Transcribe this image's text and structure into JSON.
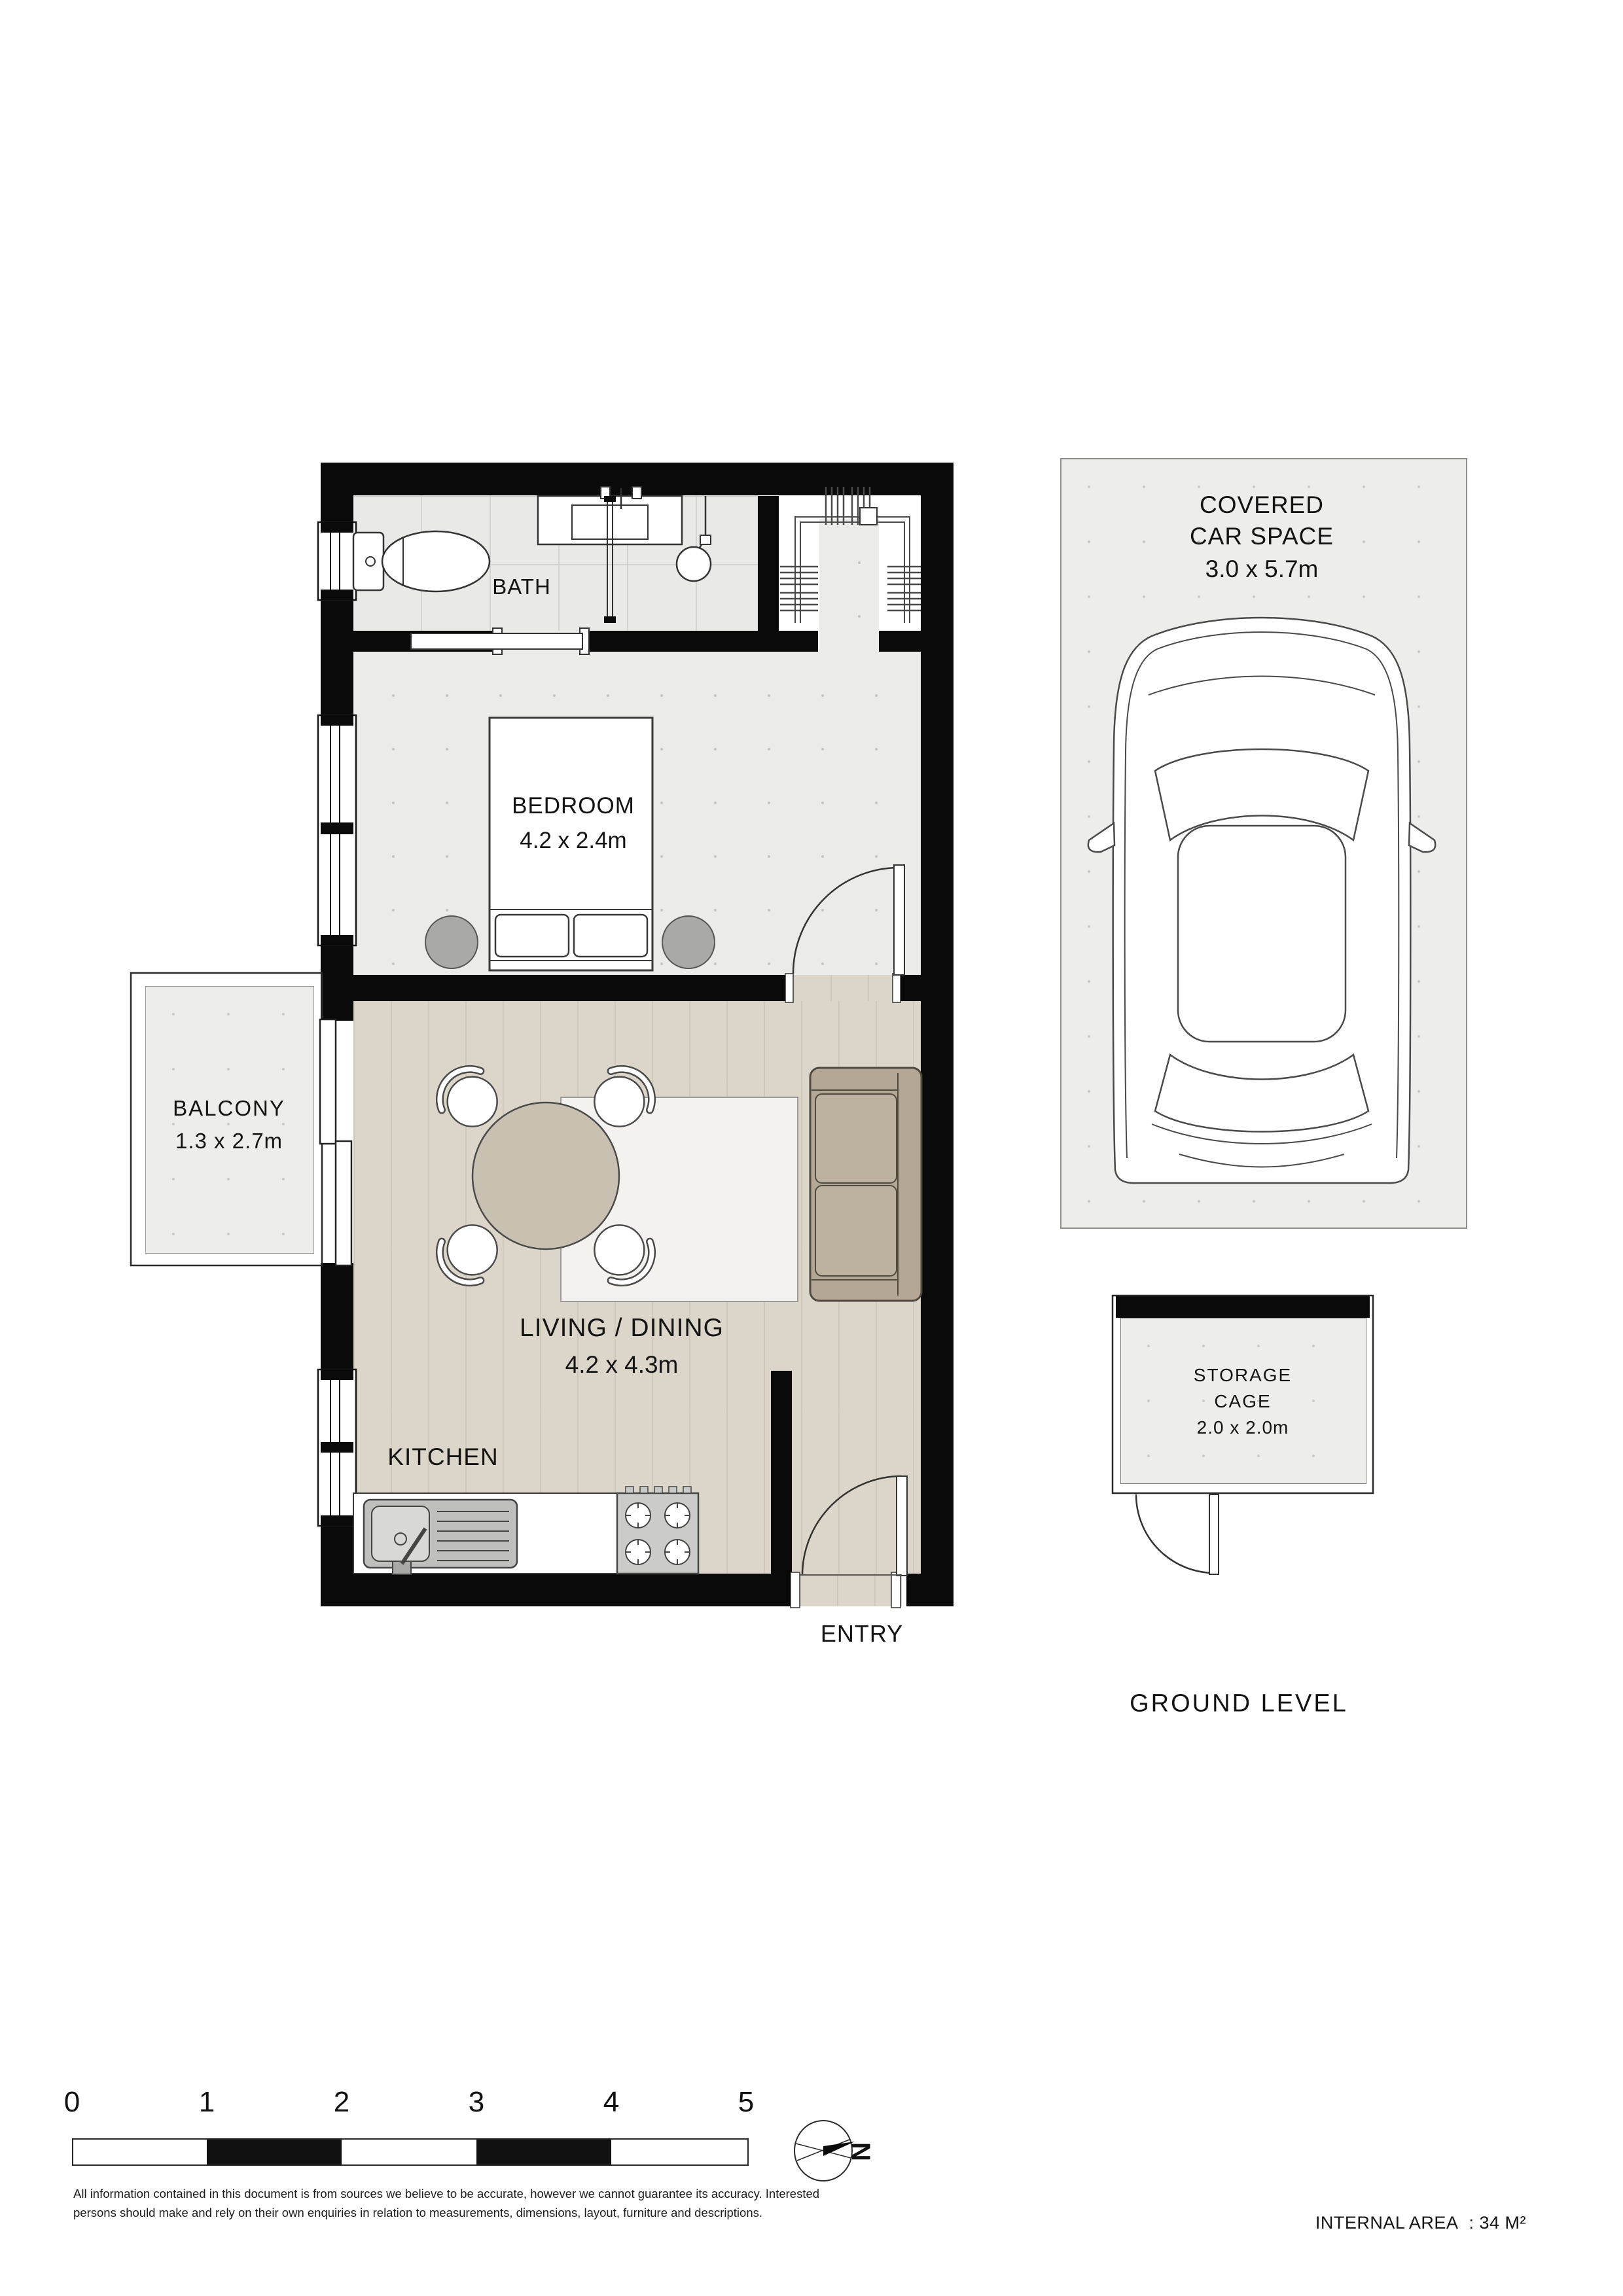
{
  "floorplan": {
    "rooms": {
      "bath": {
        "label": "BATH"
      },
      "bedroom": {
        "label": "BEDROOM",
        "dimensions": "4.2 x 2.4m"
      },
      "balcony": {
        "label": "BALCONY",
        "dimensions": "1.3 x 2.7m"
      },
      "living_dining": {
        "label": "LIVING / DINING",
        "dimensions": "4.2 x 4.3m"
      },
      "kitchen": {
        "label": "KITCHEN"
      },
      "entry": {
        "label": "ENTRY"
      },
      "covered_car_space": {
        "label_line1": "COVERED",
        "label_line2": "CAR SPACE",
        "dimensions": "3.0 x 5.7m"
      },
      "storage_cage": {
        "label_line1": "STORAGE",
        "label_line2": "CAGE",
        "dimensions": "2.0 x 2.0m"
      }
    },
    "level_label": "GROUND LEVEL",
    "compass": {
      "letter": "N"
    },
    "scale_bar": {
      "ticks": [
        "0",
        "1",
        "2",
        "3",
        "4",
        "5"
      ]
    },
    "footer": {
      "disclaimer_line1": "All information contained in this document is from sources we believe to be accurate, however we cannot guarantee its accuracy. Interested",
      "disclaimer_line2": "persons should make and rely on their own enquiries in relation to measurements, dimensions, layout, furniture and descriptions.",
      "internal_area_label": "INTERNAL AREA",
      "internal_area_value": ": 34 M²"
    },
    "colors": {
      "wall": "#0a0a0a",
      "tile_floor": "#e9e9e7",
      "dotted_floor": "#ebebe9",
      "timber_floor": "#dcd6ca",
      "rug": "#f3f2ee",
      "sofa": "#b4a795",
      "table": "#c8c1b2",
      "bedside_table": "#a9a9a7",
      "scale_bar_black": "#111111"
    }
  }
}
